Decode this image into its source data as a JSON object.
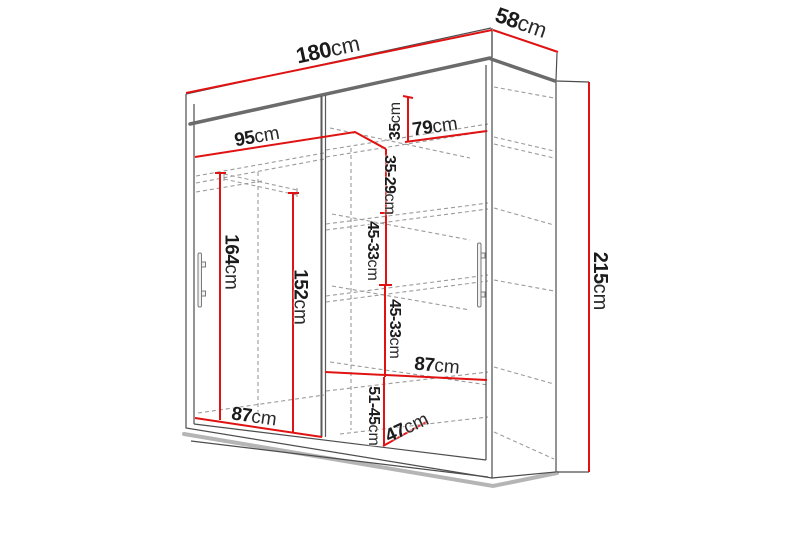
{
  "title": "Sliding-door wardrobe dimension diagram",
  "unit": "cm",
  "colors": {
    "dimension_line": "#e01212",
    "structure_line": "#4d4d4d",
    "thick_edge": "#6b6b6b",
    "hidden_line": "#9b9b9b",
    "shadow": "#b5b5b5",
    "text": "#1b1b1b",
    "background": "#ffffff"
  },
  "labels": [
    {
      "id": "total-width",
      "value": "180",
      "unit": "cm",
      "x": 328,
      "y": 50,
      "rot": -12,
      "size": 22
    },
    {
      "id": "depth",
      "value": "58",
      "unit": "cm",
      "x": 521,
      "y": 23,
      "rot": 19,
      "size": 22
    },
    {
      "id": "left-section-width",
      "value": "95",
      "unit": "cm",
      "x": 257,
      "y": 137,
      "rot": -10,
      "size": 19
    },
    {
      "id": "right-section-width",
      "value": "79",
      "unit": "cm",
      "x": 435,
      "y": 127,
      "rot": -8,
      "size": 19
    },
    {
      "id": "top-compartment-height",
      "value": "35",
      "unit": "cm",
      "x": 396,
      "y": 121,
      "rot": -90,
      "size": 16
    },
    {
      "id": "upper-compartment-height",
      "value": "35-29",
      "unit": "cm",
      "x": 389,
      "y": 185,
      "rot": 90,
      "size": 16
    },
    {
      "id": "middle-compartment-height-1",
      "value": "45-33",
      "unit": "cm",
      "x": 372,
      "y": 251,
      "rot": 90,
      "size": 16
    },
    {
      "id": "middle-compartment-height-2",
      "value": "45-33",
      "unit": "cm",
      "x": 394,
      "y": 329,
      "rot": 90,
      "size": 16
    },
    {
      "id": "lower-shelf-width",
      "value": "87",
      "unit": "cm",
      "x": 437,
      "y": 366,
      "rot": 5,
      "size": 19
    },
    {
      "id": "bottom-compartment-height",
      "value": "51-45",
      "unit": "cm",
      "x": 373,
      "y": 416,
      "rot": 90,
      "size": 16
    },
    {
      "id": "bottom-compartment-depth",
      "value": "47",
      "unit": "cm",
      "x": 407,
      "y": 428,
      "rot": -25,
      "size": 19
    },
    {
      "id": "left-floor-width",
      "value": "87",
      "unit": "cm",
      "x": 254,
      "y": 417,
      "rot": 8,
      "size": 19
    },
    {
      "id": "hanging-space-height",
      "value": "164",
      "unit": "cm",
      "x": 231,
      "y": 262,
      "rot": 90,
      "size": 19
    },
    {
      "id": "left-inner-height",
      "value": "152",
      "unit": "cm",
      "x": 300,
      "y": 297,
      "rot": 90,
      "size": 19
    },
    {
      "id": "total-height",
      "value": "215",
      "unit": "cm",
      "x": 600,
      "y": 281,
      "rot": 90,
      "size": 20
    }
  ]
}
